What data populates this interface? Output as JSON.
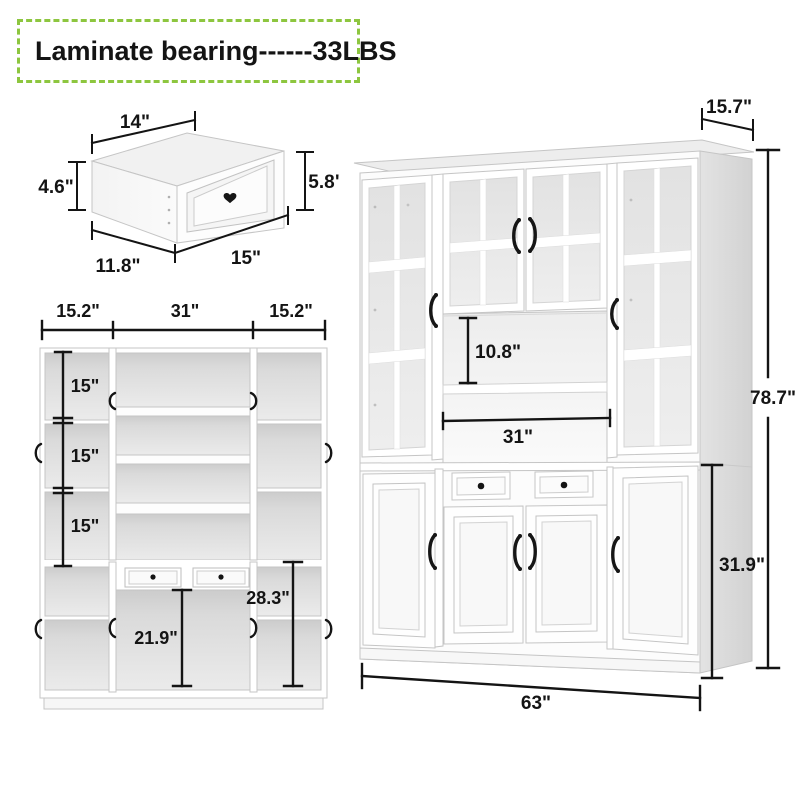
{
  "badge": {
    "label": "Laminate bearing------33LBS",
    "border_color": "#8dc63f"
  },
  "drawer_diagram": {
    "top_width": "14\"",
    "side_height": "4.6\"",
    "front_height": "5.8\"",
    "depth": "11.8\"",
    "front_width": "15\""
  },
  "front_view": {
    "top_widths": [
      "15.2\"",
      "31\"",
      "15.2\""
    ],
    "shelf_heights": [
      "15\"",
      "15\"",
      "15\""
    ],
    "lower_middle_height": "21.9\"",
    "lower_right_height": "28.3\""
  },
  "perspective_view": {
    "top_depth": "15.7\"",
    "total_height": "78.7\"",
    "opening_height": "10.8\"",
    "opening_width": "31\"",
    "lower_height": "31.9\"",
    "total_width": "63\""
  },
  "colors": {
    "accent_green": "#8dc63f",
    "dimension_line": "#141414",
    "cabinet_white": "#fdfdfd",
    "side_gray": "#d9d9d9",
    "interior_gray": "#d6d6d6",
    "glass_gray": "#e6e6e6"
  }
}
